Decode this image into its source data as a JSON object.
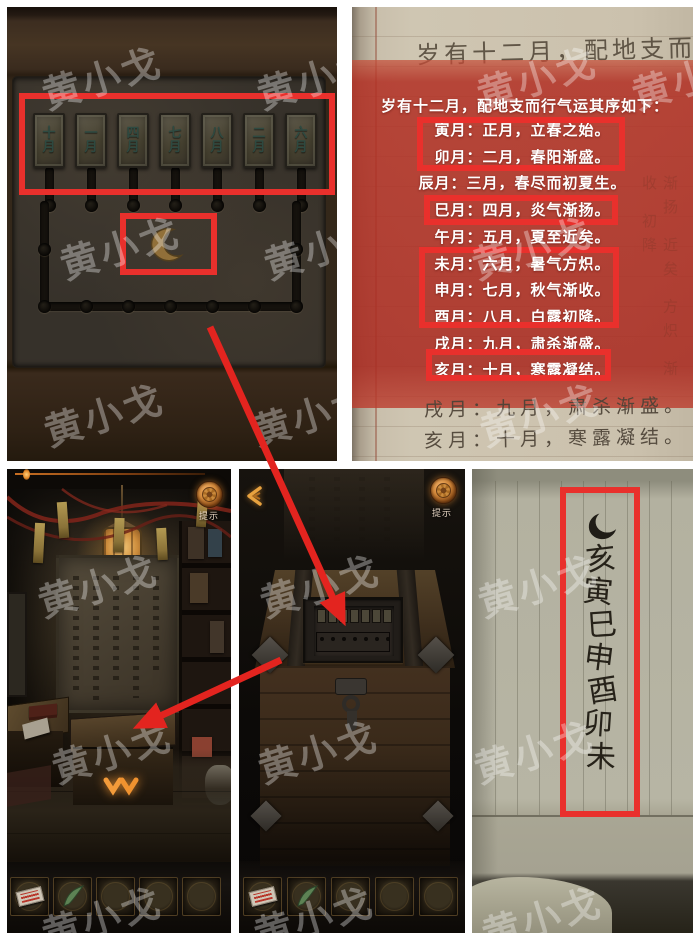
{
  "watermark": {
    "text": "黄小戈"
  },
  "top_left_panel": {
    "description": "month tile slider puzzle",
    "tiles": [
      "十月",
      "一月",
      "四月",
      "七月",
      "八月",
      "二月",
      "六月"
    ],
    "moon_symbol": "crescent-moon"
  },
  "top_right_panel": {
    "handwritten_title": "岁有十二月，配地支而行气",
    "overlay_title": "岁有十二月，配地支而行气运其序如下：",
    "month_lines": [
      {
        "text": "寅月：正月，立春之始。",
        "highlighted": true
      },
      {
        "text": "卯月：二月，春阳渐盛。",
        "highlighted": true
      },
      {
        "text": "辰月：三月，春尽而初夏生。",
        "highlighted": false
      },
      {
        "text": "巳月：四月，炎气渐扬。",
        "highlighted": true
      },
      {
        "text": "午月：五月，夏至近矣。",
        "highlighted": false
      },
      {
        "text": "未月：六月，暑气方炽。",
        "highlighted": true
      },
      {
        "text": "申月：七月，秋气渐收。",
        "highlighted": true
      },
      {
        "text": "酉月：八月，白露初降。",
        "highlighted": true
      },
      {
        "text": "戌月：九月，肃杀渐盛。",
        "highlighted": false
      },
      {
        "text": "亥月：十月，寒露凝结。",
        "highlighted": true
      }
    ],
    "handwritten_bottom_lines": [
      "戌月：九月，肃杀渐盛。",
      "亥月：十月，寒露凝结。"
    ],
    "faint_margin_text": "渐扬 近矣 方炽 渐收 初降"
  },
  "bottom_left_panel": {
    "hint_label": "提示"
  },
  "bottom_middle_panel": {
    "hint_label": "提示"
  },
  "bottom_right_panel": {
    "moon_symbol": "crescent-ink",
    "note_symbols": [
      "亥",
      "寅",
      "巳",
      "申",
      "酉",
      "卯",
      "未"
    ]
  },
  "colors": {
    "annotation_red": "#e9302c",
    "overlay_red": "#b23126",
    "gold": "#e0973c"
  }
}
